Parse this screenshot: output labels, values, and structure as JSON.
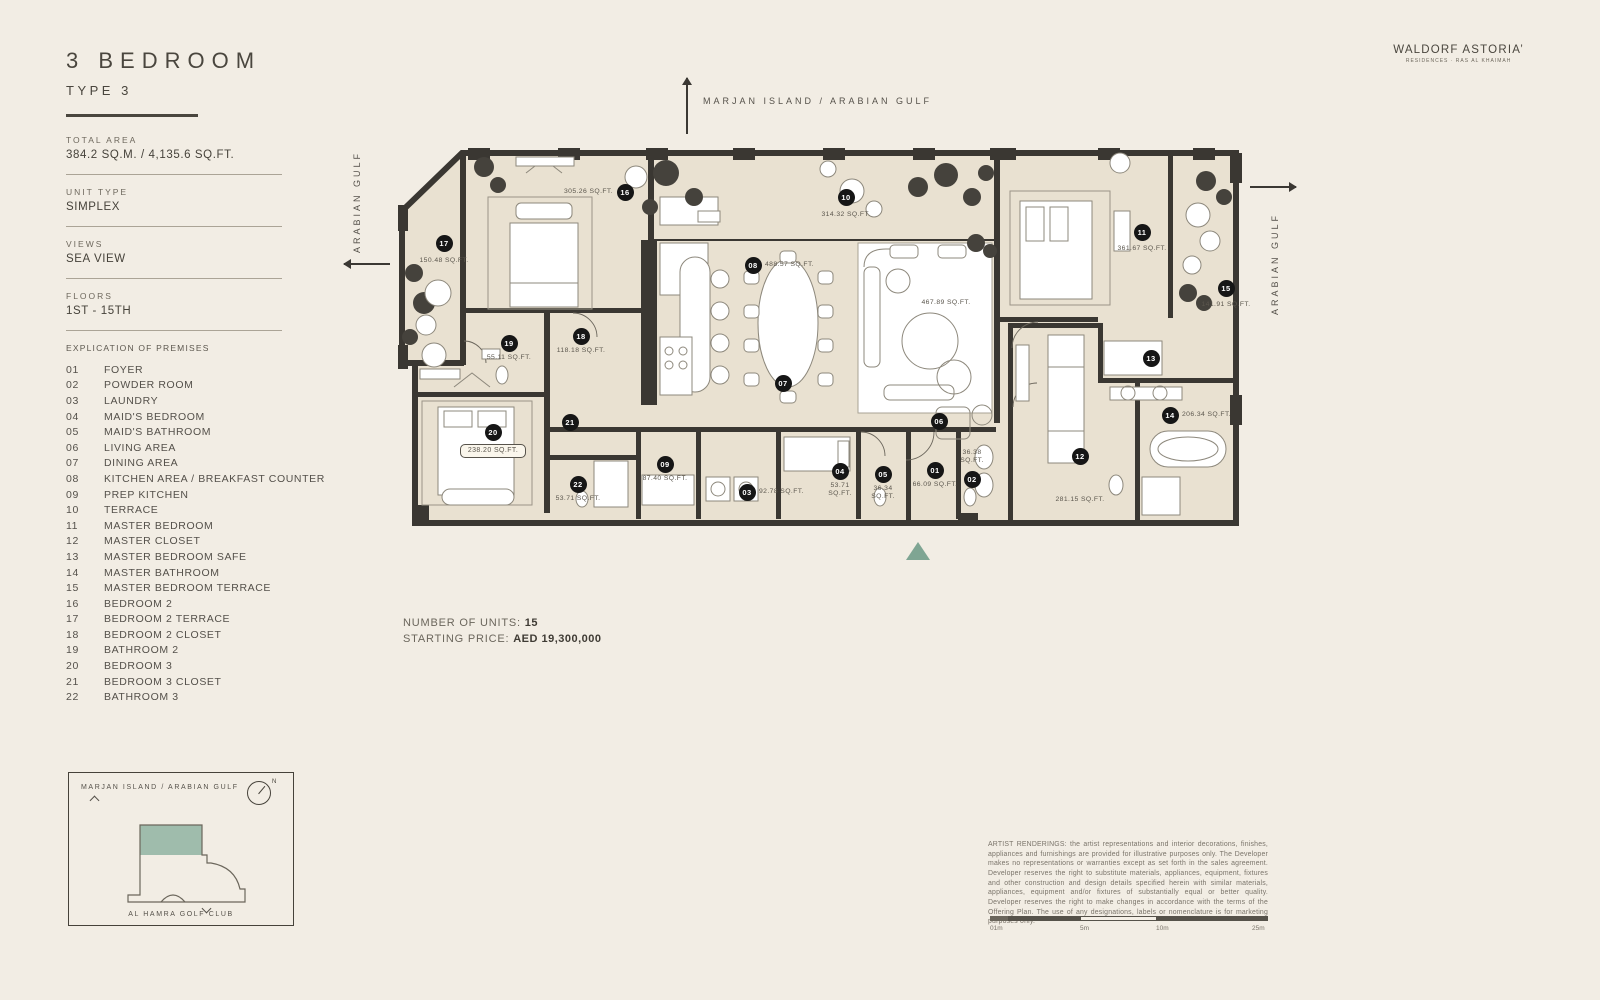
{
  "header": {
    "title": "3 BEDROOM",
    "subtitle": "TYPE 3"
  },
  "brand": {
    "name": "WALDORF ASTORIA’",
    "tagline": "RESIDENCES · RAS AL KHAIMAH"
  },
  "specs": [
    {
      "label": "TOTAL AREA",
      "value": "384.2 SQ.M.  /  4,135.6 SQ.FT."
    },
    {
      "label": "UNIT TYPE",
      "value": "SIMPLEX"
    },
    {
      "label": "VIEWS",
      "value": "SEA VIEW"
    },
    {
      "label": "FLOORS",
      "value": "1ST - 15TH"
    }
  ],
  "explication": {
    "title": "EXPLICATION OF PREMISES",
    "items": [
      {
        "num": "01",
        "name": "FOYER"
      },
      {
        "num": "02",
        "name": "POWDER ROOM"
      },
      {
        "num": "03",
        "name": "LAUNDRY"
      },
      {
        "num": "04",
        "name": "MAID'S BEDROOM"
      },
      {
        "num": "05",
        "name": "MAID'S BATHROOM"
      },
      {
        "num": "06",
        "name": "LIVING AREA"
      },
      {
        "num": "07",
        "name": "DINING AREA"
      },
      {
        "num": "08",
        "name": "KITCHEN AREA / BREAKFAST COUNTER"
      },
      {
        "num": "09",
        "name": "PREP KITCHEN"
      },
      {
        "num": "10",
        "name": "TERRACE"
      },
      {
        "num": "11",
        "name": "MASTER BEDROOM"
      },
      {
        "num": "12",
        "name": "MASTER CLOSET"
      },
      {
        "num": "13",
        "name": "MASTER BEDROOM SAFE"
      },
      {
        "num": "14",
        "name": "MASTER BATHROOM"
      },
      {
        "num": "15",
        "name": "MASTER BEDROOM TERRACE"
      },
      {
        "num": "16",
        "name": "BEDROOM 2"
      },
      {
        "num": "17",
        "name": "BEDROOM 2 TERRACE"
      },
      {
        "num": "18",
        "name": "BEDROOM 2 CLOSET"
      },
      {
        "num": "19",
        "name": "BATHROOM 2"
      },
      {
        "num": "20",
        "name": "BEDROOM 3"
      },
      {
        "num": "21",
        "name": "BEDROOM 3 CLOSET"
      },
      {
        "num": "22",
        "name": "BATHROOM 3"
      }
    ]
  },
  "compass": {
    "top": "MARJAN ISLAND / ARABIAN GULF",
    "left": "ARABIAN GULF",
    "right": "ARABIAN GULF"
  },
  "plan": {
    "free_labels": [
      {
        "text": "467.89 SQ.FT.",
        "x": 548,
        "y": 154
      }
    ],
    "markers": [
      {
        "num": "16",
        "x": 227,
        "y": 47,
        "area": "305.26 SQ.FT.",
        "apos": "left"
      },
      {
        "num": "10",
        "x": 448,
        "y": 52,
        "area": "314.32 SQ.FT.",
        "apos": "below",
        "dy": 14
      },
      {
        "num": "17",
        "x": 46,
        "y": 98,
        "area": "150.48 SQ.FT.",
        "apos": "below",
        "dy": 14
      },
      {
        "num": "11",
        "x": 744,
        "y": 87,
        "area": "361.67 SQ.FT.",
        "apos": "below",
        "dy": 13
      },
      {
        "num": "08",
        "x": 355,
        "y": 120,
        "area": "488.57 SQ.FT.",
        "apos": "right"
      },
      {
        "num": "15",
        "x": 828,
        "y": 143,
        "area": "141.91 SQ.FT.",
        "apos": "below",
        "dy": 13
      },
      {
        "num": "19",
        "x": 111,
        "y": 198,
        "area": "55.11 SQ.FT.",
        "apos": "below"
      },
      {
        "num": "18",
        "x": 183,
        "y": 191,
        "area": "118.18 SQ.FT.",
        "apos": "below"
      },
      {
        "num": "13",
        "x": 753,
        "y": 213
      },
      {
        "num": "07",
        "x": 385,
        "y": 238
      },
      {
        "num": "06",
        "x": 541,
        "y": 276
      },
      {
        "num": "14",
        "x": 772,
        "y": 270,
        "area": "206.34 SQ.FT.",
        "apos": "right"
      },
      {
        "num": "12",
        "x": 682,
        "y": 311,
        "area": "281.15 SQ.FT.",
        "apos": "below",
        "dy": 40
      },
      {
        "num": "20",
        "x": 95,
        "y": 287,
        "area": "238.20 SQ.FT.",
        "apos": "below",
        "dy": 12,
        "boxed": true
      },
      {
        "num": "21",
        "x": 172,
        "y": 277
      },
      {
        "num": "22",
        "x": 180,
        "y": 339,
        "area": "53.71 SQ.FT.",
        "apos": "below"
      },
      {
        "num": "09",
        "x": 267,
        "y": 319,
        "area": "87.40 SQ.FT.",
        "apos": "below"
      },
      {
        "num": "03",
        "x": 349,
        "y": 347,
        "area": "92.78 SQ.FT.",
        "apos": "right"
      },
      {
        "num": "04",
        "x": 442,
        "y": 326,
        "area": "53.71\nSQ.FT.",
        "apos": "below"
      },
      {
        "num": "05",
        "x": 485,
        "y": 329,
        "area": "36.34\nSQ.FT.",
        "apos": "below"
      },
      {
        "num": "01",
        "x": 537,
        "y": 325,
        "area": "66.09 SQ.FT.",
        "apos": "below"
      },
      {
        "num": "02",
        "x": 574,
        "y": 334,
        "area": "36.38\nSQ.FT.",
        "apos": "above"
      }
    ]
  },
  "footer": {
    "units_label": "NUMBER OF UNITS: ",
    "units_value": "15",
    "price_label": "STARTING PRICE: ",
    "price_value": "AED 19,300,000"
  },
  "inset": {
    "title": "MARJAN ISLAND / ARABIAN GULF",
    "bottom_label": "AL HAMRA GOLF CLUB",
    "north": "N"
  },
  "disclaimer": "ARTIST RENDERINGS: the artist representations and interior decorations, finishes, appliances and furnishings are provided for illustrative purposes only. The Developer makes no representations or warranties except as set forth in the sales agreement. Developer reserves the right to substitute materials, appliances, equipment, fixtures and other construction and design details specified herein with similar materials, appliances, equipment and/or fixtures of substantially equal or better quality. Developer reserves the right to make changes in accordance with the terms of the Offering Plan. The use of any designations, labels or nomenclature is for marketing purposes only.",
  "scale": {
    "ticks": [
      {
        "label": "01m",
        "x": 0
      },
      {
        "label": "5m",
        "x": 90
      },
      {
        "label": "10m",
        "x": 166
      },
      {
        "label": "25m",
        "x": 262
      }
    ]
  },
  "colors": {
    "accent_teal": "#7fa593",
    "map_highlight": "#9fbcac",
    "badge": "#161616",
    "wall": "#3a3732"
  }
}
